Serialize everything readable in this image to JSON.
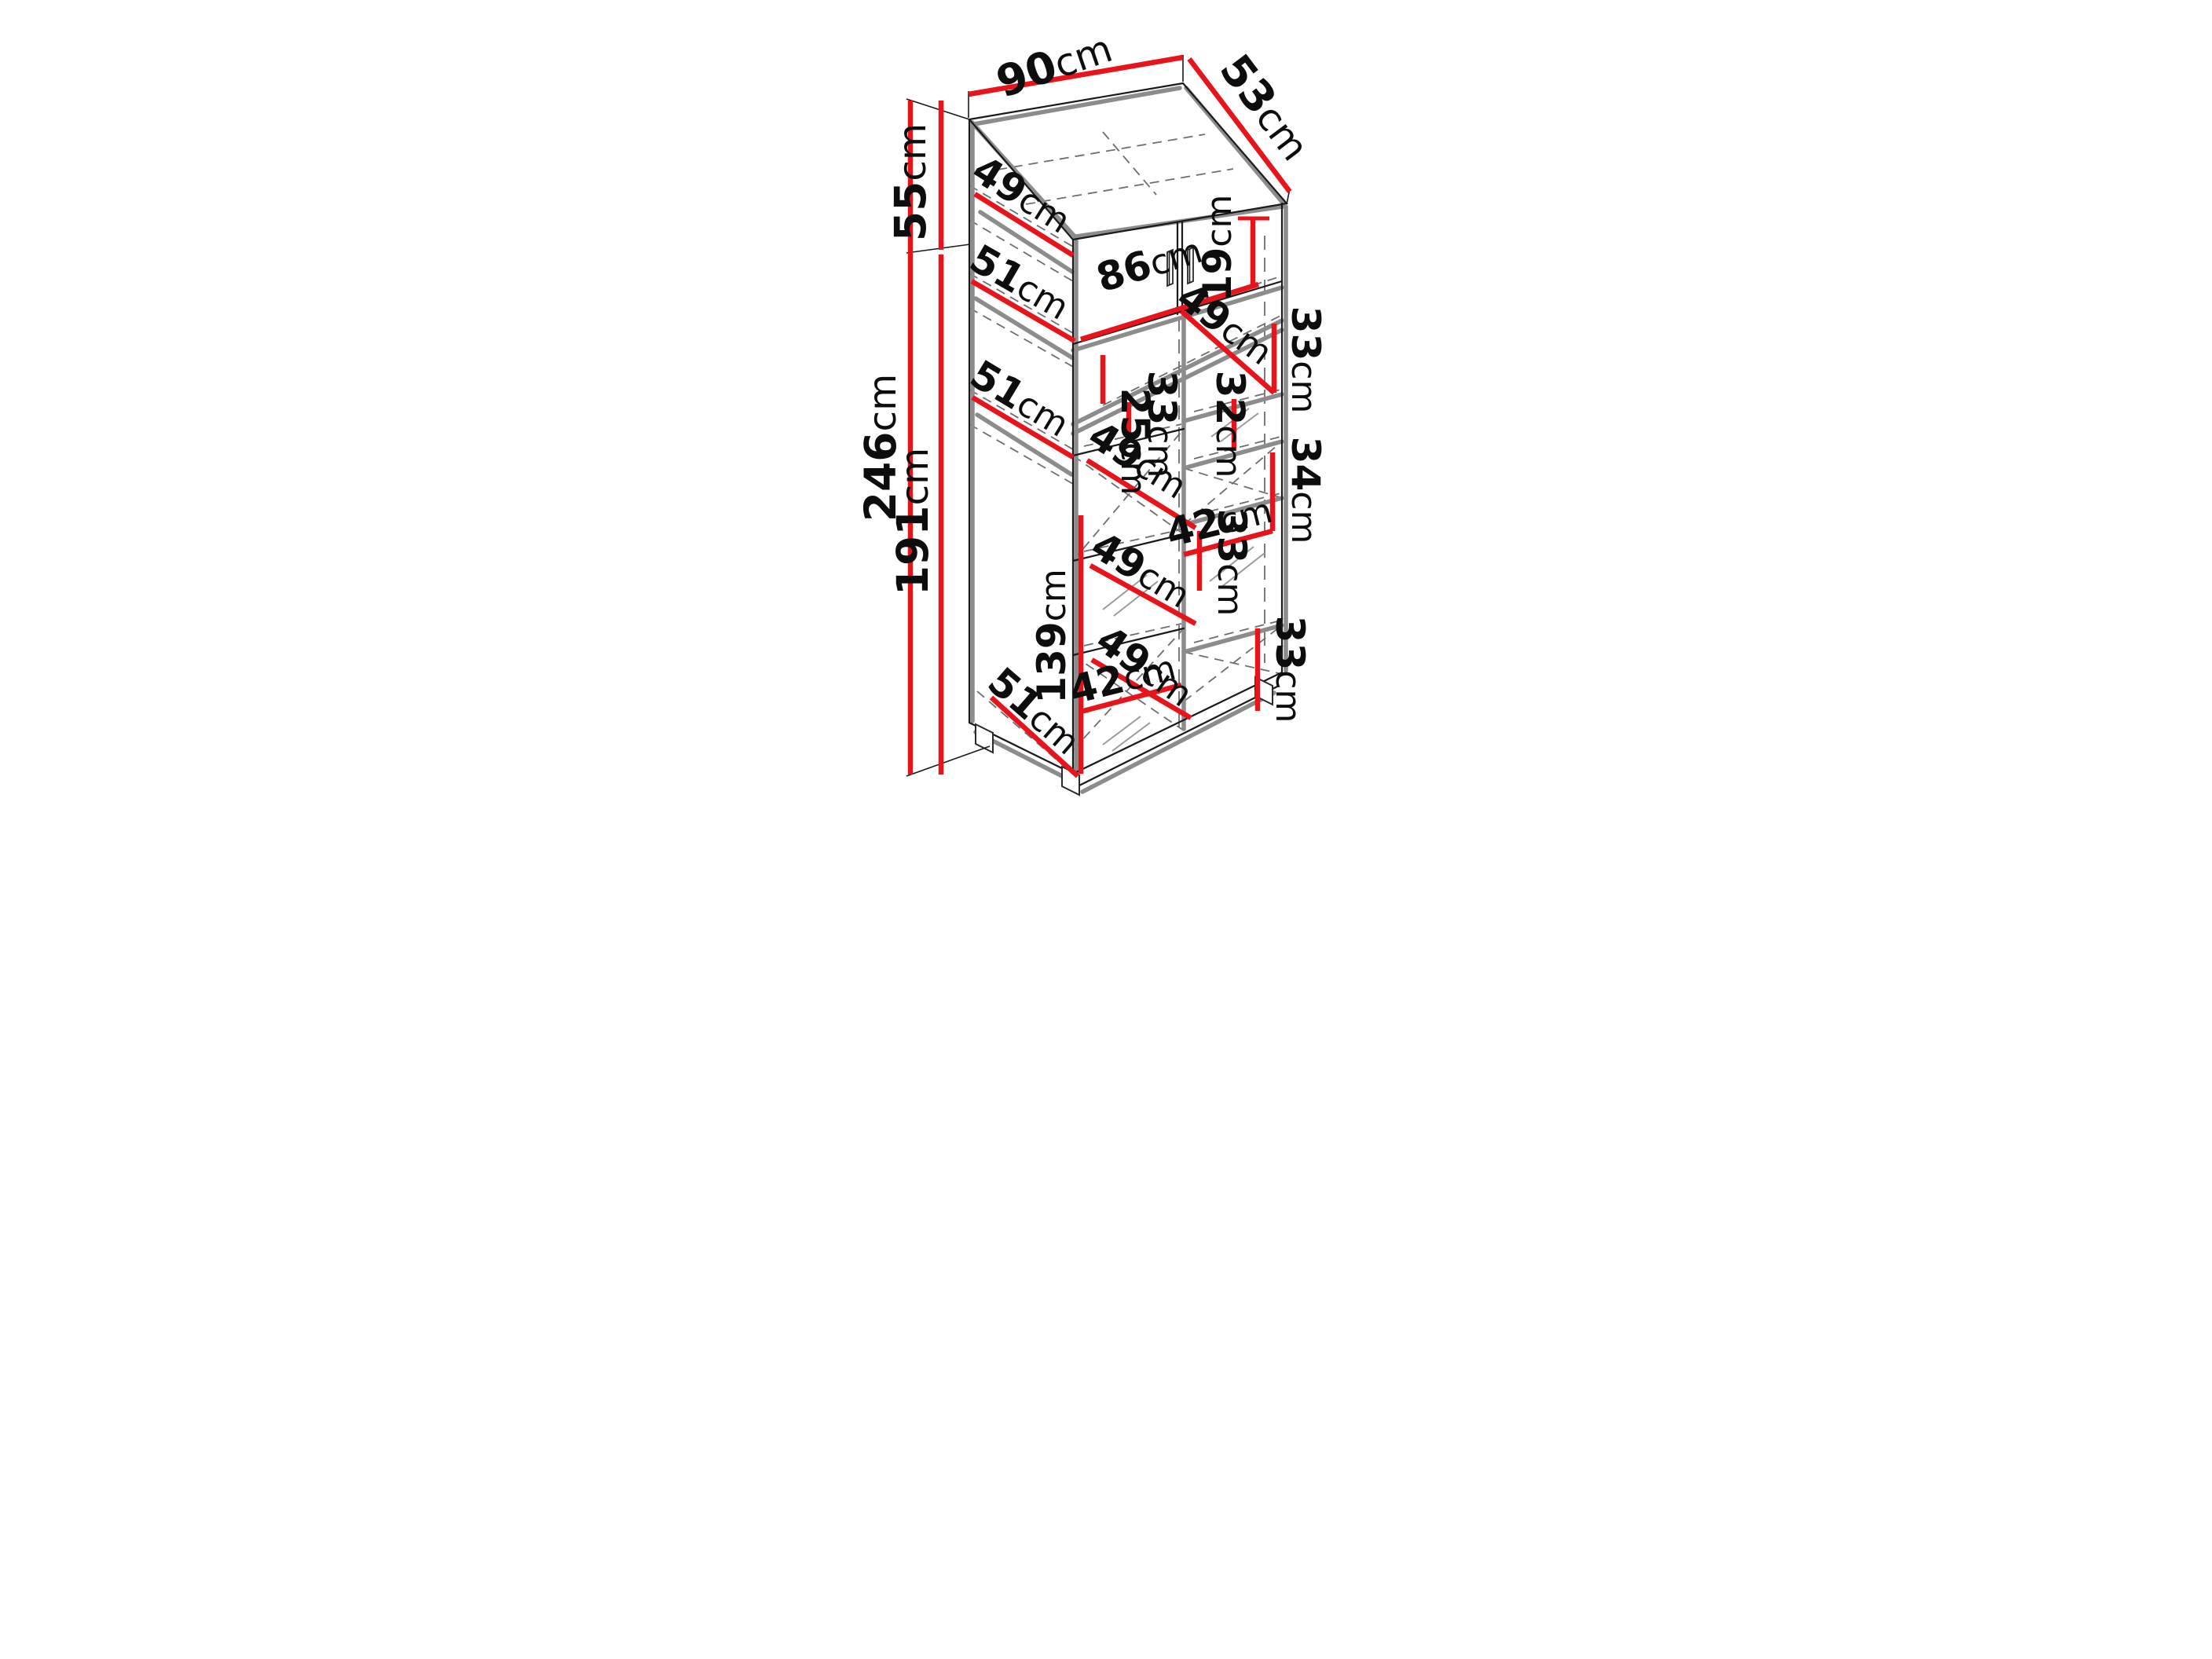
{
  "diagram": {
    "type": "furniture-dimension-drawing",
    "subject": "two-door wardrobe cutaway with shelf dimensions",
    "unit": "cm",
    "colors": {
      "dimension": "#e8141b",
      "outline": "#1a1a1a",
      "panel": "#8c8c8c",
      "hidden": "#6e6e6e",
      "text": "#0d0d0d",
      "bg": "#ffffff"
    },
    "dims": {
      "top_width": {
        "num": "90",
        "unit": "cm"
      },
      "top_depth": {
        "num": "53",
        "unit": "cm"
      },
      "left_upper": {
        "num": "55",
        "unit": "cm"
      },
      "left_total": {
        "num": "246",
        "unit": "cm"
      },
      "left_lower": {
        "num": "191",
        "unit": "cm"
      },
      "side_top_49": {
        "num": "49",
        "unit": "cm"
      },
      "side_51_upper": {
        "num": "51",
        "unit": "cm"
      },
      "side_51_mid": {
        "num": "51",
        "unit": "cm"
      },
      "side_51_bottom": {
        "num": "51",
        "unit": "cm"
      },
      "front_86": {
        "num": "86",
        "unit": "cm"
      },
      "niche_19": {
        "num": "19",
        "unit": "cm"
      },
      "door_25": {
        "num": "25",
        "unit": "cm"
      },
      "left_col_33": {
        "num": "33",
        "unit": "cm"
      },
      "left_col_49_a": {
        "num": "49",
        "unit": "cm"
      },
      "left_col_49_b": {
        "num": "49",
        "unit": "cm"
      },
      "left_col_49_c": {
        "num": "49",
        "unit": "cm"
      },
      "left_col_42": {
        "num": "42",
        "unit": "cm"
      },
      "left_col_139": {
        "num": "139",
        "unit": "cm"
      },
      "right_col_49": {
        "num": "49",
        "unit": "cm"
      },
      "right_col_33_top": {
        "num": "33",
        "unit": "cm"
      },
      "right_col_32": {
        "num": "32",
        "unit": "cm"
      },
      "right_col_34": {
        "num": "34",
        "unit": "cm"
      },
      "right_col_42": {
        "num": "42",
        "unit": "cm"
      },
      "right_col_33_mid": {
        "num": "33",
        "unit": "cm"
      },
      "right_col_33_bot": {
        "num": "33",
        "unit": "cm"
      }
    }
  }
}
